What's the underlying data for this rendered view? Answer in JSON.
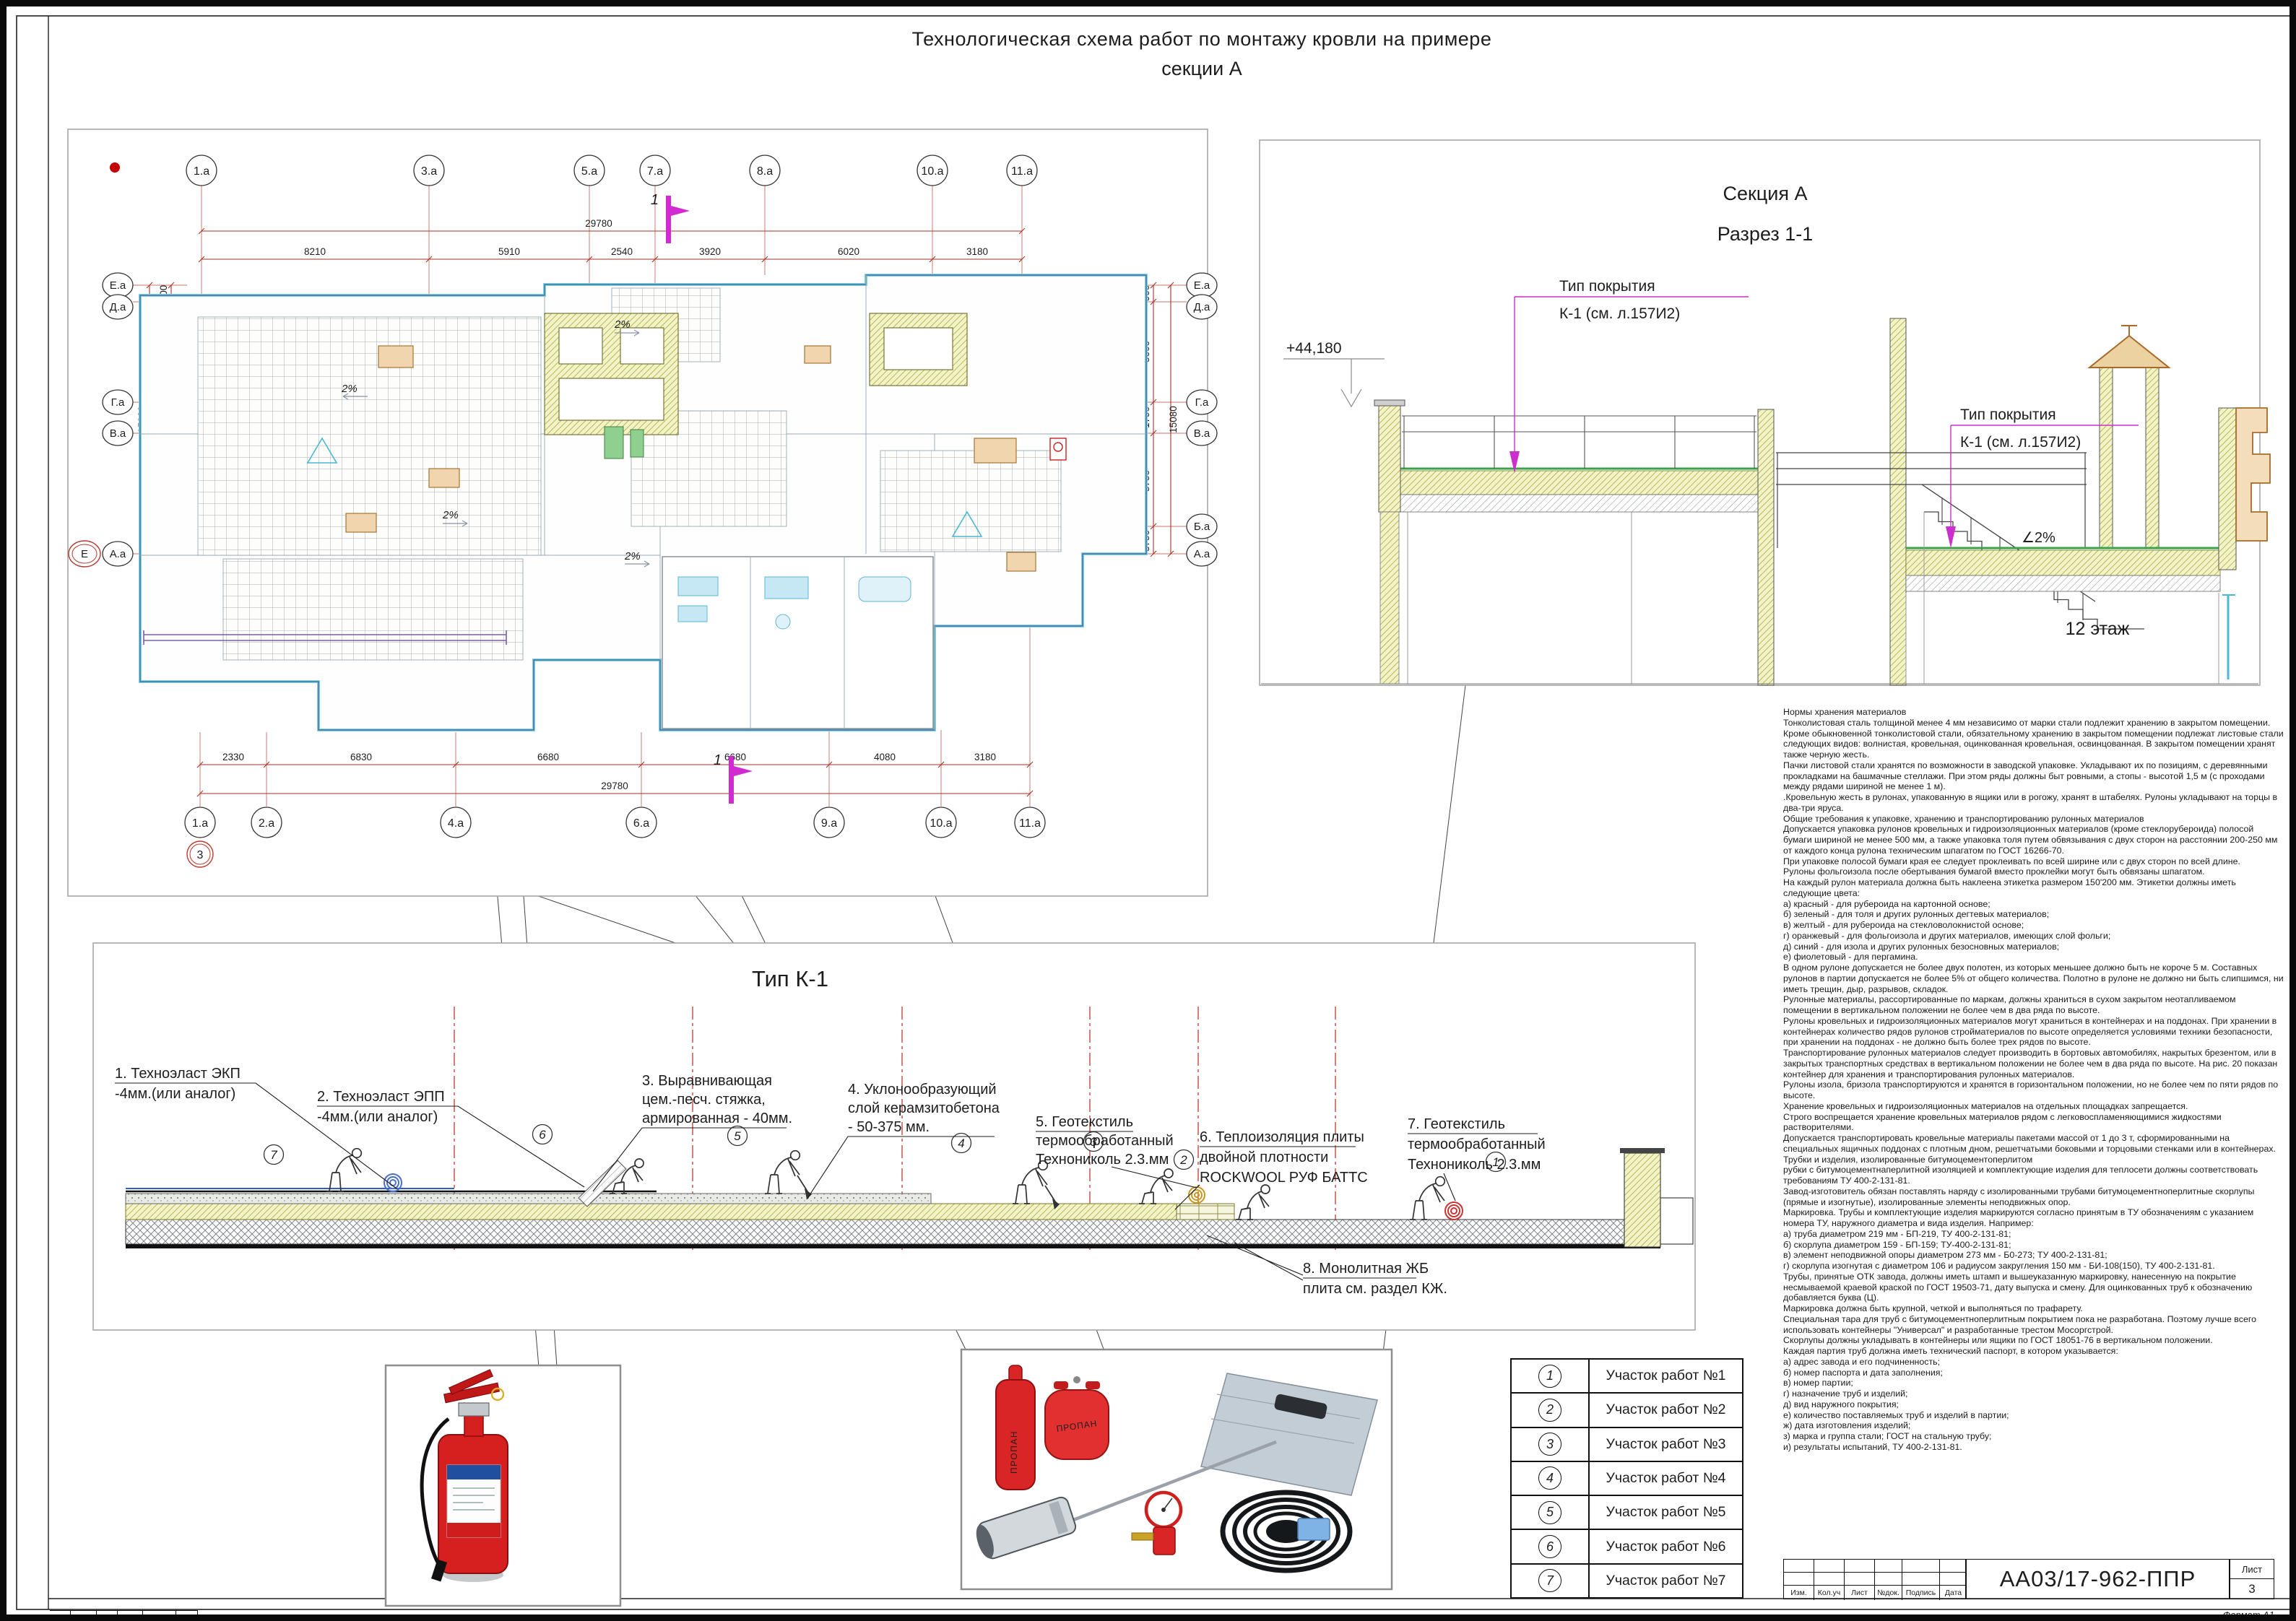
{
  "title": {
    "line1": "Технологическая схема работ по монтажу кровли на примере",
    "line2": "секции А"
  },
  "plan": {
    "axes_top": [
      "1.а",
      "3.а",
      "5.а",
      "7.а",
      "8.а",
      "10.а",
      "11.а"
    ],
    "dims_top": [
      "8210",
      "5910",
      "2540",
      "3920",
      "6020",
      "3180"
    ],
    "total_top": "29780",
    "axes_bottom": [
      "1.а",
      "2.а",
      "4.а",
      "6.а",
      "9.а",
      "10.а",
      "11.а"
    ],
    "dims_bottom": [
      "2330",
      "6830",
      "6680",
      "6680",
      "4080",
      "3180"
    ],
    "total_bottom": "29780",
    "axes_left": [
      "Е.а",
      "Д.а",
      "Г.а",
      "В.а",
      "А.а"
    ],
    "axis_left_extra": "Е",
    "sheet_mark": "3",
    "dims_left": [
      "900",
      "5600",
      "1790",
      "6790"
    ],
    "total_left": "15080",
    "axes_right": [
      "Е.а",
      "Д.а",
      "Г.а",
      "В.а",
      "Б.а",
      "А.а"
    ],
    "dims_right": [
      "900",
      "5600",
      "1790",
      "5750",
      "3750"
    ],
    "total_right": "15080",
    "section_mark": "1",
    "slope": "2%"
  },
  "section": {
    "title": "Секция А",
    "subtitle": "Разрез 1-1",
    "elevation": "+44,180",
    "coating_line1": "Тип покрытия",
    "coating_line2": "К-1 (см. л.157И2)",
    "slope": "∠2%",
    "floor": "12 этаж"
  },
  "k1": {
    "title": "Тип К-1",
    "badges": [
      "7",
      "6",
      "5",
      "4",
      "3",
      "2",
      "1"
    ],
    "labels": [
      {
        "l1": "1. Техноэласт ЭКП",
        "l2": "-4мм.(или аналог)"
      },
      {
        "l1": "2. Техноэласт ЭПП",
        "l2": "-4мм.(или аналог)"
      },
      {
        "l1": "3. Выравнивающая",
        "l2": "цем.-песч.  стяжка,",
        "l3": "армированная - 40мм."
      },
      {
        "l1": "4. Уклонообразующий",
        "l2": "слой  керамзитобетона",
        "l3": "- 50-375 мм."
      },
      {
        "l1": "5. Геотекстиль",
        "l2": "термообработанный",
        "l3": "Технониколь 2.3.мм"
      },
      {
        "l1": "6. Теплоизоляция плиты",
        "l2": "двойной плотности",
        "l3": "ROCKWOOL РУФ БАТТС"
      },
      {
        "l1": "7. Геотекстиль",
        "l2": "термообработанный",
        "l3": "Технониколь 2.3.мм"
      },
      {
        "l1": "8. Монолитная ЖБ",
        "l2": "плита см. раздел КЖ."
      }
    ]
  },
  "equipment": {
    "propane_label": "ПРОПАН"
  },
  "worksites": {
    "nums": [
      "1",
      "2",
      "3",
      "4",
      "5",
      "6",
      "7"
    ],
    "rows": [
      "Участок работ №1",
      "Участок работ №2",
      "Участок работ №3",
      "Участок работ №4",
      "Участок работ №5",
      "Участок работ №6",
      "Участок работ №7"
    ]
  },
  "stamp": {
    "cols": [
      "Изм.",
      "Кол.уч",
      "Лист",
      "№док.",
      "Подпись",
      "Дата"
    ],
    "doc": "АА03/17-962-ППР",
    "sheet_label": "Лист",
    "sheet_no": "3",
    "format": "Формат А1"
  },
  "footer": {
    "cols": [
      "Изм.",
      "Колич",
      "Лист",
      "№док",
      "Подпись",
      "Дата"
    ]
  },
  "norms": {
    "text": "Нормы хранения материалов\nТонколистовая сталь толщиной менее 4 мм независимо от марки стали подлежит хранению в закрытом помещении. Кроме обыкновенной тонколистовой стали, обязательному хранению в закрытом помещении подлежат листовые стали следующих видов: волнистая, кровельная, оцинкованная кровельная, освинцованная. В закрытом помещении хранят также черную жесть.\nПачки листовой стали хранятся по возможности в заводской упаковке. Укладывают их по позициям, с деревянными прокладками на башмачные стеллажи. При этом ряды должны быт ровными, а стопы - высотой 1,5 м (с проходами между рядами шириной не менее 1 м).\n.Кровельную жесть в рулонах, упакованную в ящики или в рогожу, хранят в штабелях. Рулоны укладывают на торцы в два-три яруса.\nОбщие требования к упаковке, хранению и транспортированию рулонных материалов\nДопускается упаковка рулонов кровельных и гидроизоляционных материалов (кроме стеклорубероида) полосой бумаги шириной не менее 500 мм, а также упаковка толя путем обвязывания с двух сторон на расстоянии 200-250 мм от каждого конца рулона техническим шпагатом по ГОСТ 16266-70.\nПри упаковке полосой бумаги края ее следует проклеивать по всей ширине или с двух сторон по всей длине.\nРулоны фольгоизола после обертывания бумагой вместо проклейки могут быть обвязаны шпагатом.\nНа каждый рулон материала должна быть наклеена этикетка размером 150'200 мм. Этикетки должны иметь следующие цвета:\nа) красный - для рубероида на картонной основе;\nб) зеленый - для толя и других рулонных дегтевых материалов;\nв) желтый - для рубероида на стекловолокнистой основе;\nг) оранжевый - для фольгоизола и других материалов, имеющих слой фольги;\nд) синий - для изола и других рулонных безосновных материалов;\nе) фиолетовый - для пергамина.\nВ одном рулоне допускается не более двух полотен, из которых меньшее должно быть не короче 5 м. Составных рулонов в партии допускается не более 5% от общего количества. Полотно в рулоне не должно ни быть слипшимся, ни иметь трещин, дыр, разрывов, складок.\nРулонные материалы, рассортированные по маркам, должны храниться в сухом закрытом неотапливаемом помещении в вертикальном положении не более чем в два ряда по высоте.\nРулоны кровельных и гидроизоляционных материалов могут храниться в контейнерах и на поддонах. При хранении в контейнерах количество рядов рулонов стройматериалов по высоте определяется условиями техники безопасности, при хранении на поддонах - не должно быть более трех рядов по высоте.\nТранспортирование рулонных материалов следует производить в бортовых автомобилях, накрытых брезентом, или в закрытых транспортных средствах в вертикальном положении не более чем в два ряда по высоте. На рис. 20 показан контейнер для хранения и транспортирования рулонных материалов.\nРулоны изола, бризола транспортируются и хранятся в горизонтальном положении, но не более чем по пяти рядов по высоте.\nХранение кровельных и гидроизоляционных материалов на отдельных площадках запрещается.\nСтрого воспрещается хранение кровельных материалов рядом с легковоспламеняющимися жидкостями растворителями.\nДопускается транспортировать кровельные материалы пакетами массой от 1 до 3 т, сформированными на специальных ящичных поддонах с плотным дном, решетчатыми боковыми и торцовыми стенками или в контейнерах.\nТрубки и изделия, изолированные битумоцементоперлитом\nрубки с битумоцементнаперлитной изоляцией и комплектующие изделия для теплосети должны соответствовать требованиям ТУ 400-2-131-81.\nЗавод-изготовитель обязан поставлять наряду с изолированными трубами битумоцементноперлитные скорлупы (прямые и изогнутые), изолированные элементы неподвижных опор.\nМаркировка. Трубы и комплектующие изделия маркируются согласно принятым в ТУ обозначениям с указанием номера ТУ, наружного диаметра и вида изделия. Например:\nа) труба диаметром 219 мм - БП-219, ТУ 400-2-131-81;\nб) скорлупа диаметром 159 - БП-159; ТУ-400-2-131-81;\nв) элемент неподвижной опоры диаметром 273 мм - Б0-273; ТУ 400-2-131-81;\nг) скорлупа изогнутая с диаметром 106 и радиусом закругления 150 мм - БИ-108(150), ТУ 400-2-131-81.\nТрубы, принятые ОТК завода, должны иметь штамп и вышеуказанную маркировку, нанесенную на покрытие несмываемой краевой краской по ГОСТ 19503-71, дату выпуска и смену. Для оцинкованных труб к обозначению добавляется буква (Ц).\nМаркировка должна быть крупной, четкой и выполняться по трафарету.\nСпециальная тара для труб с битумоцементноперлитным покрытием пока не разработана. Поэтому лучше всего использовать контейнеры \"Универсал\" и разработанные трестом Мосоргстрой.\nСкорлупы должны укладывать в контейнеры или ящики по ГОСТ 18051-76 в вертикальном положении.\nКаждая партия труб должна иметь технический паспорт, в котором указывается:\nа) адрес завода и его подчиненность;\nб) номер паспорта и дата заполнения;\nв) номер партии;\nг) назначение труб и изделий;\nд) вид наружного покрытия;\nе) количество поставляемых труб и изделий в партии;\nж) дата изготовления изделий;\nз) марка и группа стали; ГОСТ на стальную трубу;\nи) результаты испытаний, ТУ 400-2-131-81."
  }
}
